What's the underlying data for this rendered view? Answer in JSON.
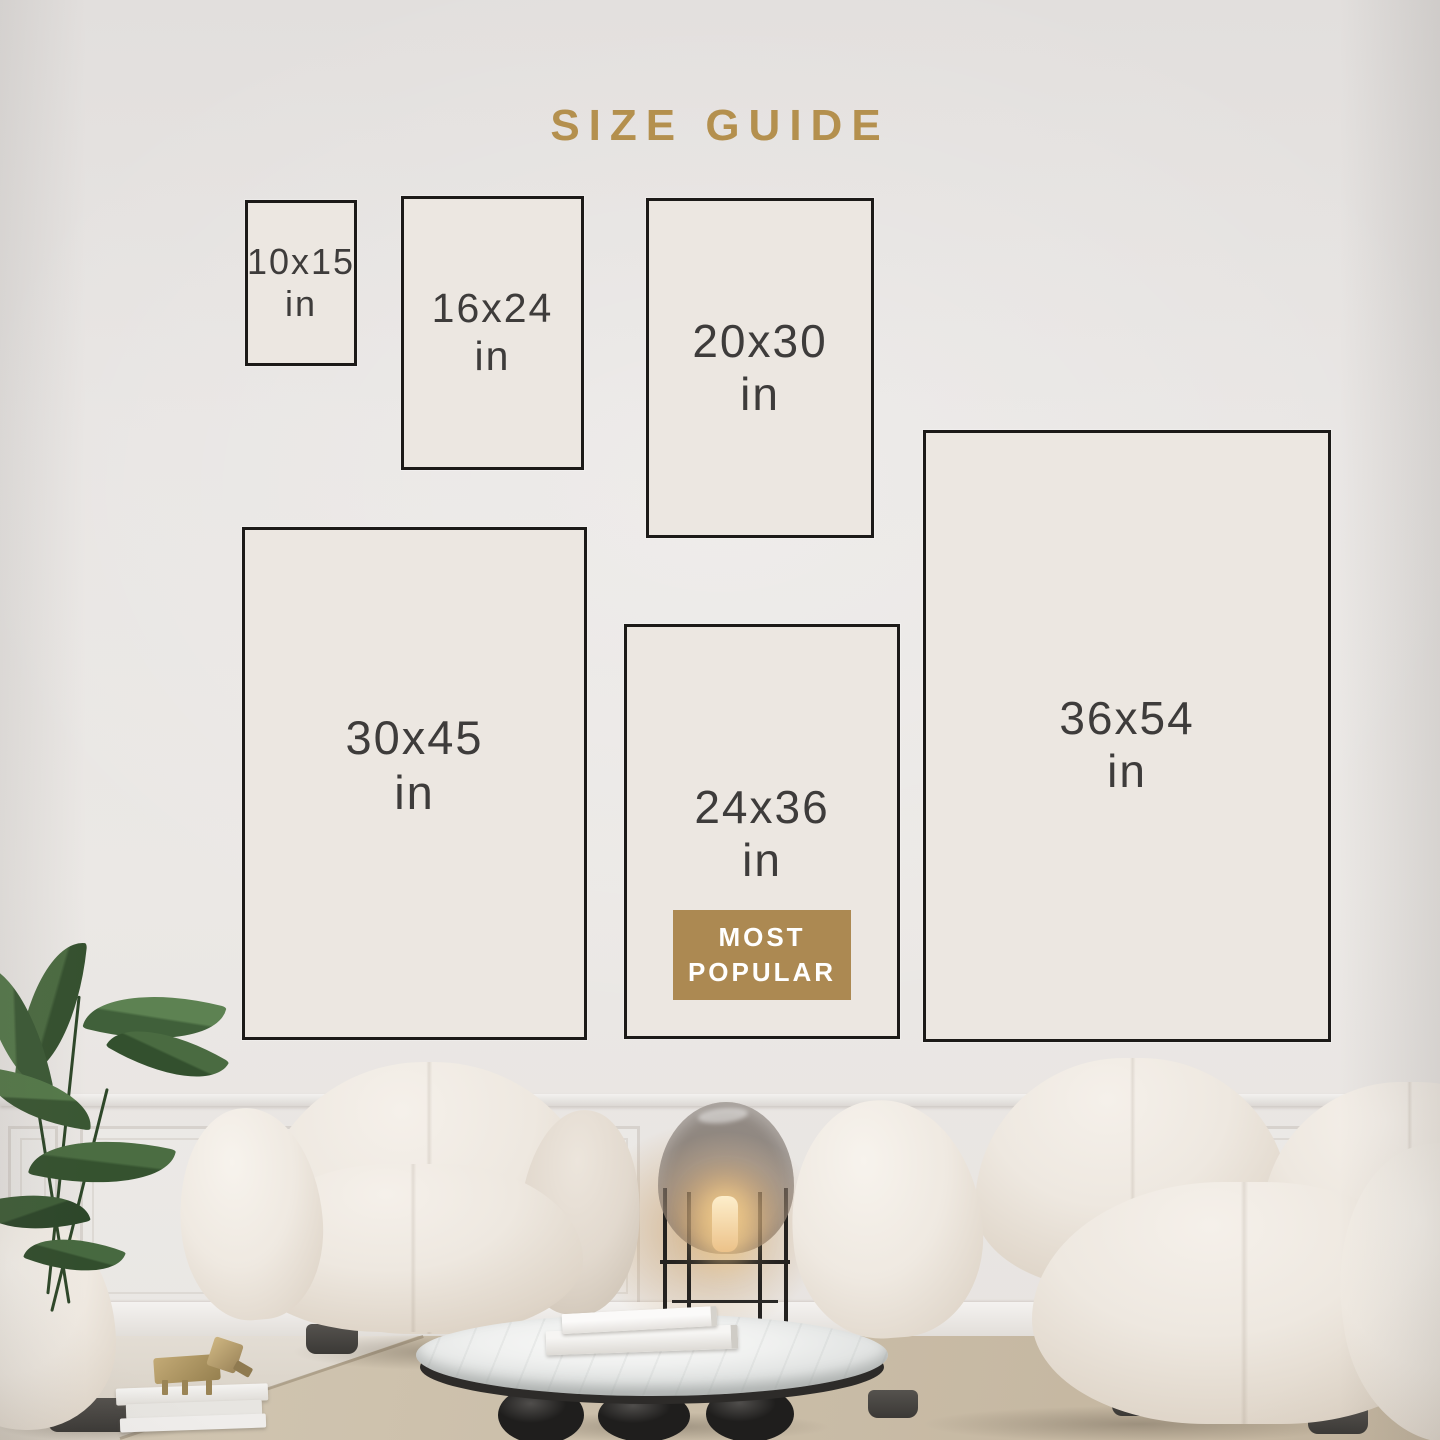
{
  "title": "SIZE GUIDE",
  "sizes": [
    {
      "label": "10x15",
      "unit": "in"
    },
    {
      "label": "16x24",
      "unit": "in"
    },
    {
      "label": "20x30",
      "unit": "in"
    },
    {
      "label": "30x45",
      "unit": "in"
    },
    {
      "label": "24x36",
      "unit": "in",
      "badge": {
        "line1": "MOST",
        "line2": "POPULAR"
      }
    },
    {
      "label": "36x54",
      "unit": "in"
    }
  ],
  "colors": {
    "accent_gold": "#b4904e",
    "badge_bg": "#ac8952",
    "badge_text": "#ffffff",
    "size_text": "#3e3c3b",
    "card_fill": "#ece7e1",
    "card_border": "#1c1a18"
  }
}
